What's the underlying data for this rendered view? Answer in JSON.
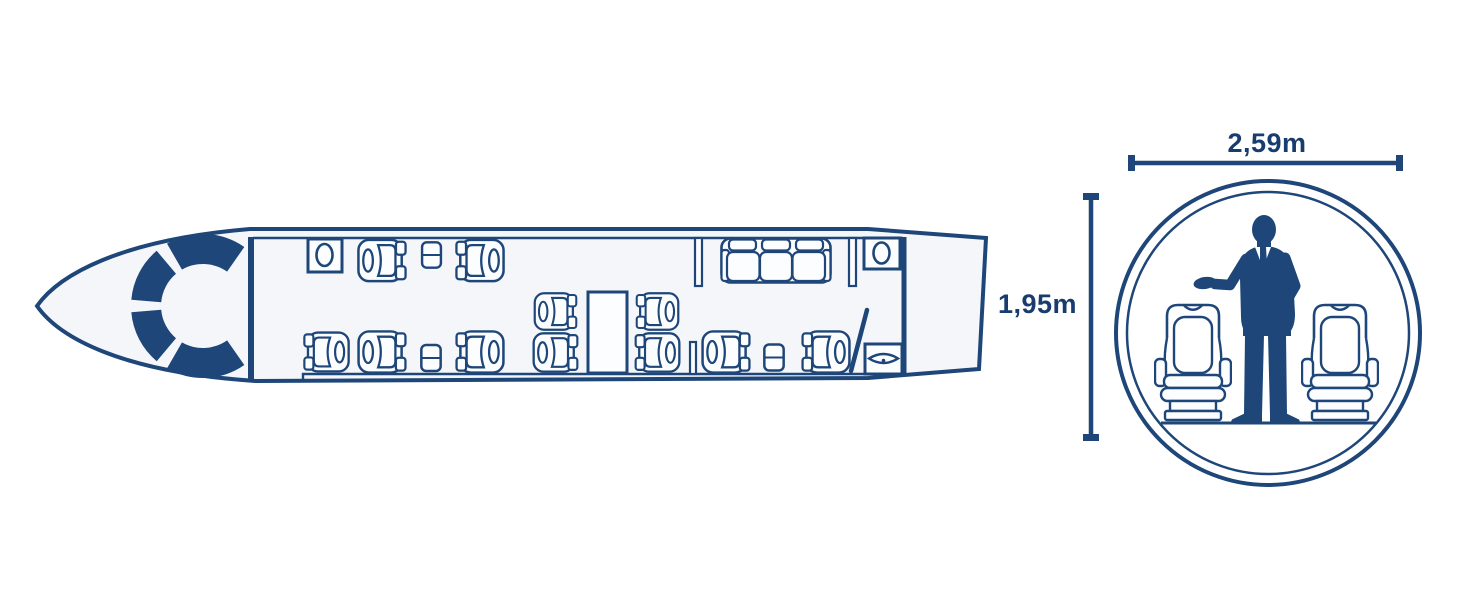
{
  "cross_section": {
    "width_label": "2,59m",
    "height_label": "1,95m"
  },
  "colors": {
    "primary_navy": "#1e4679",
    "label_ink": "#183c6d",
    "cabin_fill": "#f4f6f9",
    "background": "#ffffff"
  },
  "icons": {
    "cockpit_panel": "segmented-arc",
    "club_seat": "seat-top-view",
    "divan": "three-seat-sofa-top-view",
    "side_table": "split-rectangle",
    "conference_table": "rectangle",
    "toilet": "oval-in-box",
    "sink": "vesica-with-dot-in-box",
    "lavatory_door": "diagonal-line",
    "passenger": "businessman-silhouette",
    "cabin_seat_front": "seat-front-view"
  },
  "floorplan_contents": {
    "club_seats": 11,
    "divan_seats": 3,
    "side_tables": 3,
    "conference_tables": 1,
    "lavatories": 1
  }
}
